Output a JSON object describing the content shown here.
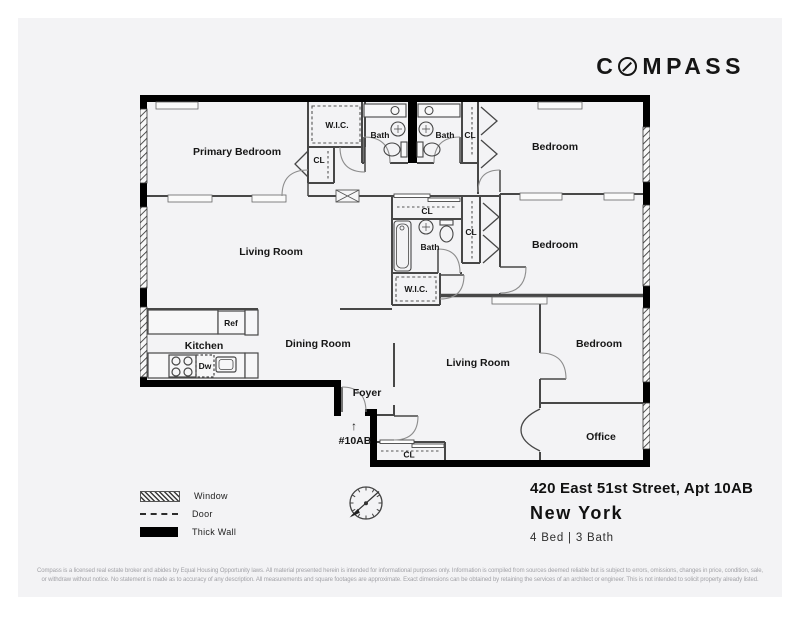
{
  "brand": {
    "logo_prefix": "C",
    "logo_suffix": "MPASS"
  },
  "plan": {
    "rooms": {
      "primary_bedroom": "Primary Bedroom",
      "wic_top": "W.I.C.",
      "cl_primary": "CL",
      "bath_top_left": "Bath",
      "bath_top_right": "Bath",
      "cl_top_right": "CL",
      "bedroom_top_right": "Bedroom",
      "living_room_upper": "Living Room",
      "cl_mid_top": "CL",
      "bath_mid": "Bath",
      "cl_mid_right": "CL",
      "bedroom_mid_right": "Bedroom",
      "wic_mid": "W.I.C.",
      "kitchen": "Kitchen",
      "ref": "Ref",
      "dw": "Dw",
      "dining_room": "Dining Room",
      "foyer": "Foyer",
      "living_room_lower": "Living Room",
      "bedroom_bottom_right": "Bedroom",
      "office": "Office",
      "cl_bottom": "CL",
      "unit_label": "#10AB",
      "entry_arrow": "↑"
    }
  },
  "legend": {
    "window": "Window",
    "door": "Door",
    "thick_wall": "Thick Wall"
  },
  "address": {
    "line1": "420 East 51st Street, Apt 10AB",
    "city": "New York",
    "beds_baths": "4 Bed | 3 Bath"
  },
  "disclaimer": {
    "line1": "Compass is a licensed real estate broker and abides by Equal Housing Opportunity laws. All material presented herein is intended for informational purposes only. Information is compiled from sources deemed reliable but is subject to errors, omissions, changes in price, condition, sale,",
    "line2": "or withdraw without notice. No statement is made as to accuracy of any description. All measurements and square footages are approximate. Exact dimensions can be obtained by retaining the services of an architect or engineer. This is not intended to solicit property already listed."
  },
  "colors": {
    "thick_wall": "#000000",
    "thin_wall": "#474747",
    "card_bg": "#f3f3f5",
    "label": "#161616",
    "muted_text": "#a2a2a7"
  }
}
